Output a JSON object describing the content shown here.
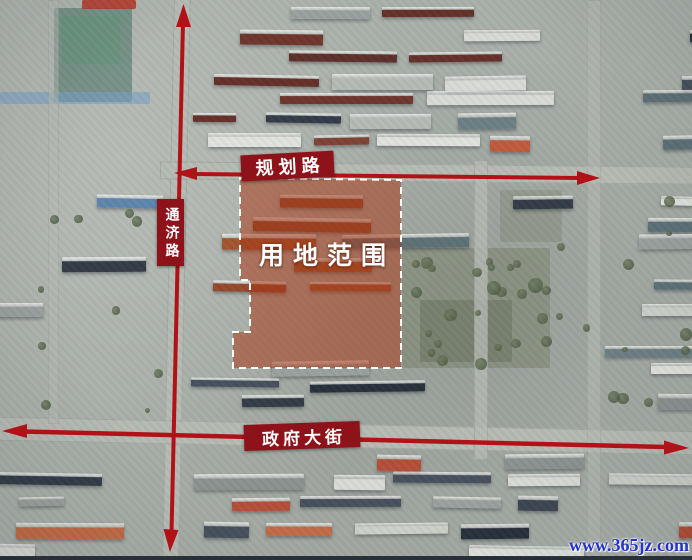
{
  "map": {
    "type": "satellite-planning-annotation",
    "roads": {
      "north_road": "规划路",
      "west_road": "通济路",
      "south_road": "政府大街"
    },
    "site": {
      "label": "用地范围"
    },
    "watermark": "www.365jz.com",
    "colors": {
      "arrow_red": "#b11218",
      "label_bg": "#8e1219",
      "label_text": "#ffffff",
      "site_fill": "rgba(168,54,20,0.52)",
      "site_border": "#ffffff",
      "watermark_blue": "#2433cc"
    }
  }
}
